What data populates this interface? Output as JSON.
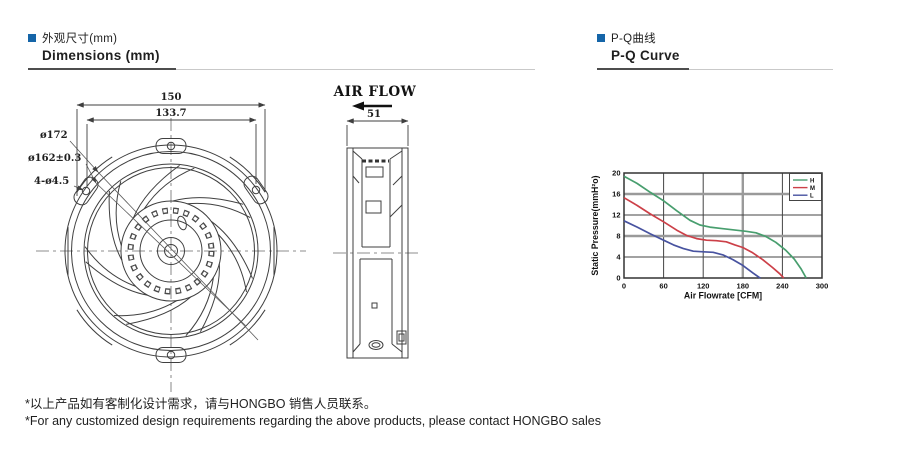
{
  "page": {
    "accent_color": "#1565a8",
    "section_left": {
      "title_zh": "外观尺寸(mm)",
      "title_en": "Dimensions (mm)"
    },
    "section_right": {
      "title_zh": "P-Q曲线",
      "title_en": "P-Q Curve"
    },
    "notes": {
      "zh": "*以上产品如有客制化设计需求，请与HONGBO 销售人员联系。",
      "en": "*For any customized design requirements regarding the above products, please contact HONGBO sales"
    }
  },
  "drawing": {
    "front_view": {
      "dim_width": "150",
      "dim_hole_spacing": "133.7",
      "label_outer_dia": "ø172",
      "label_inner_dia": "ø162±0.3",
      "label_holes": "4-ø4.5"
    },
    "side_view": {
      "air_flow_label": "AIR FLOW",
      "dim_depth": "51"
    }
  },
  "chart_data": {
    "type": "line",
    "title": "",
    "xlabel": "Air Flowrate  [CFM]",
    "ylabel": "Static Pressure(mmH²o)",
    "xlim": [
      0,
      300
    ],
    "ylim": [
      0,
      20
    ],
    "xticks": [
      0,
      60,
      120,
      180,
      240,
      300
    ],
    "yticks": [
      0,
      4,
      8,
      12,
      16,
      20
    ],
    "grid": true,
    "emphasized_grid_x": [
      180
    ],
    "emphasized_grid_y": [
      8,
      16
    ],
    "legend_position": "top-right",
    "series": [
      {
        "name": "H",
        "color": "#489e6e",
        "points": [
          [
            0,
            19.4
          ],
          [
            20,
            18.0
          ],
          [
            40,
            16.3
          ],
          [
            60,
            14.7
          ],
          [
            80,
            12.8
          ],
          [
            100,
            11.0
          ],
          [
            115,
            10.1
          ],
          [
            130,
            9.7
          ],
          [
            150,
            9.4
          ],
          [
            170,
            9.1
          ],
          [
            185,
            8.9
          ],
          [
            200,
            8.6
          ],
          [
            215,
            7.9
          ],
          [
            230,
            6.8
          ],
          [
            245,
            5.3
          ],
          [
            258,
            3.6
          ],
          [
            268,
            1.8
          ],
          [
            276,
            0
          ]
        ]
      },
      {
        "name": "M",
        "color": "#cc4048",
        "points": [
          [
            0,
            15.3
          ],
          [
            20,
            13.8
          ],
          [
            40,
            12.2
          ],
          [
            60,
            10.7
          ],
          [
            80,
            9.1
          ],
          [
            95,
            8.1
          ],
          [
            110,
            7.5
          ],
          [
            125,
            7.2
          ],
          [
            140,
            7.1
          ],
          [
            155,
            6.9
          ],
          [
            168,
            6.3
          ],
          [
            180,
            5.8
          ],
          [
            195,
            4.8
          ],
          [
            210,
            3.5
          ],
          [
            225,
            2.0
          ],
          [
            236,
            0.8
          ],
          [
            242,
            0
          ]
        ]
      },
      {
        "name": "L",
        "color": "#4853a0",
        "points": [
          [
            0,
            10.9
          ],
          [
            20,
            9.7
          ],
          [
            40,
            8.4
          ],
          [
            60,
            7.2
          ],
          [
            75,
            6.3
          ],
          [
            90,
            5.6
          ],
          [
            105,
            5.1
          ],
          [
            120,
            5.0
          ],
          [
            135,
            4.9
          ],
          [
            150,
            4.4
          ],
          [
            165,
            3.5
          ],
          [
            180,
            2.4
          ],
          [
            195,
            1.0
          ],
          [
            205,
            0.1
          ],
          [
            207,
            0
          ]
        ]
      }
    ]
  }
}
